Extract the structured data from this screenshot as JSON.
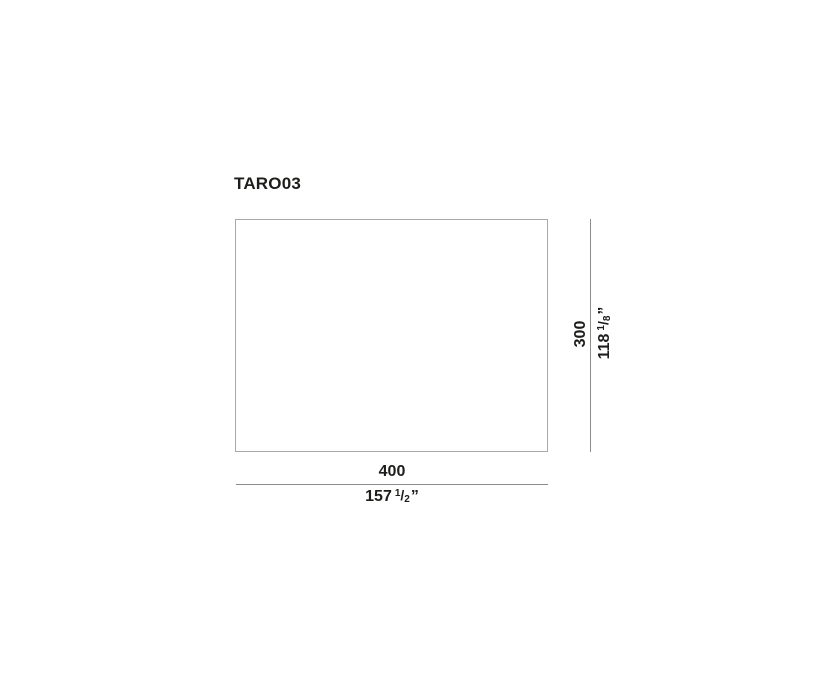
{
  "product": {
    "code": "TARO03"
  },
  "dimensions": {
    "width": {
      "cm": "400",
      "inches_whole": "157",
      "fraction_numerator": "1",
      "fraction_slash": "/",
      "fraction_denominator": "2",
      "unit_mark": "”"
    },
    "height": {
      "cm": "300",
      "inches_whole": "118",
      "fraction_numerator": "1",
      "fraction_slash": "/",
      "fraction_denominator": "8",
      "unit_mark": "”"
    }
  },
  "colors": {
    "background": "#ffffff",
    "text": "#1d1d1b",
    "outline": "#a9a9a9",
    "dimension_line": "#8c8c8c"
  }
}
